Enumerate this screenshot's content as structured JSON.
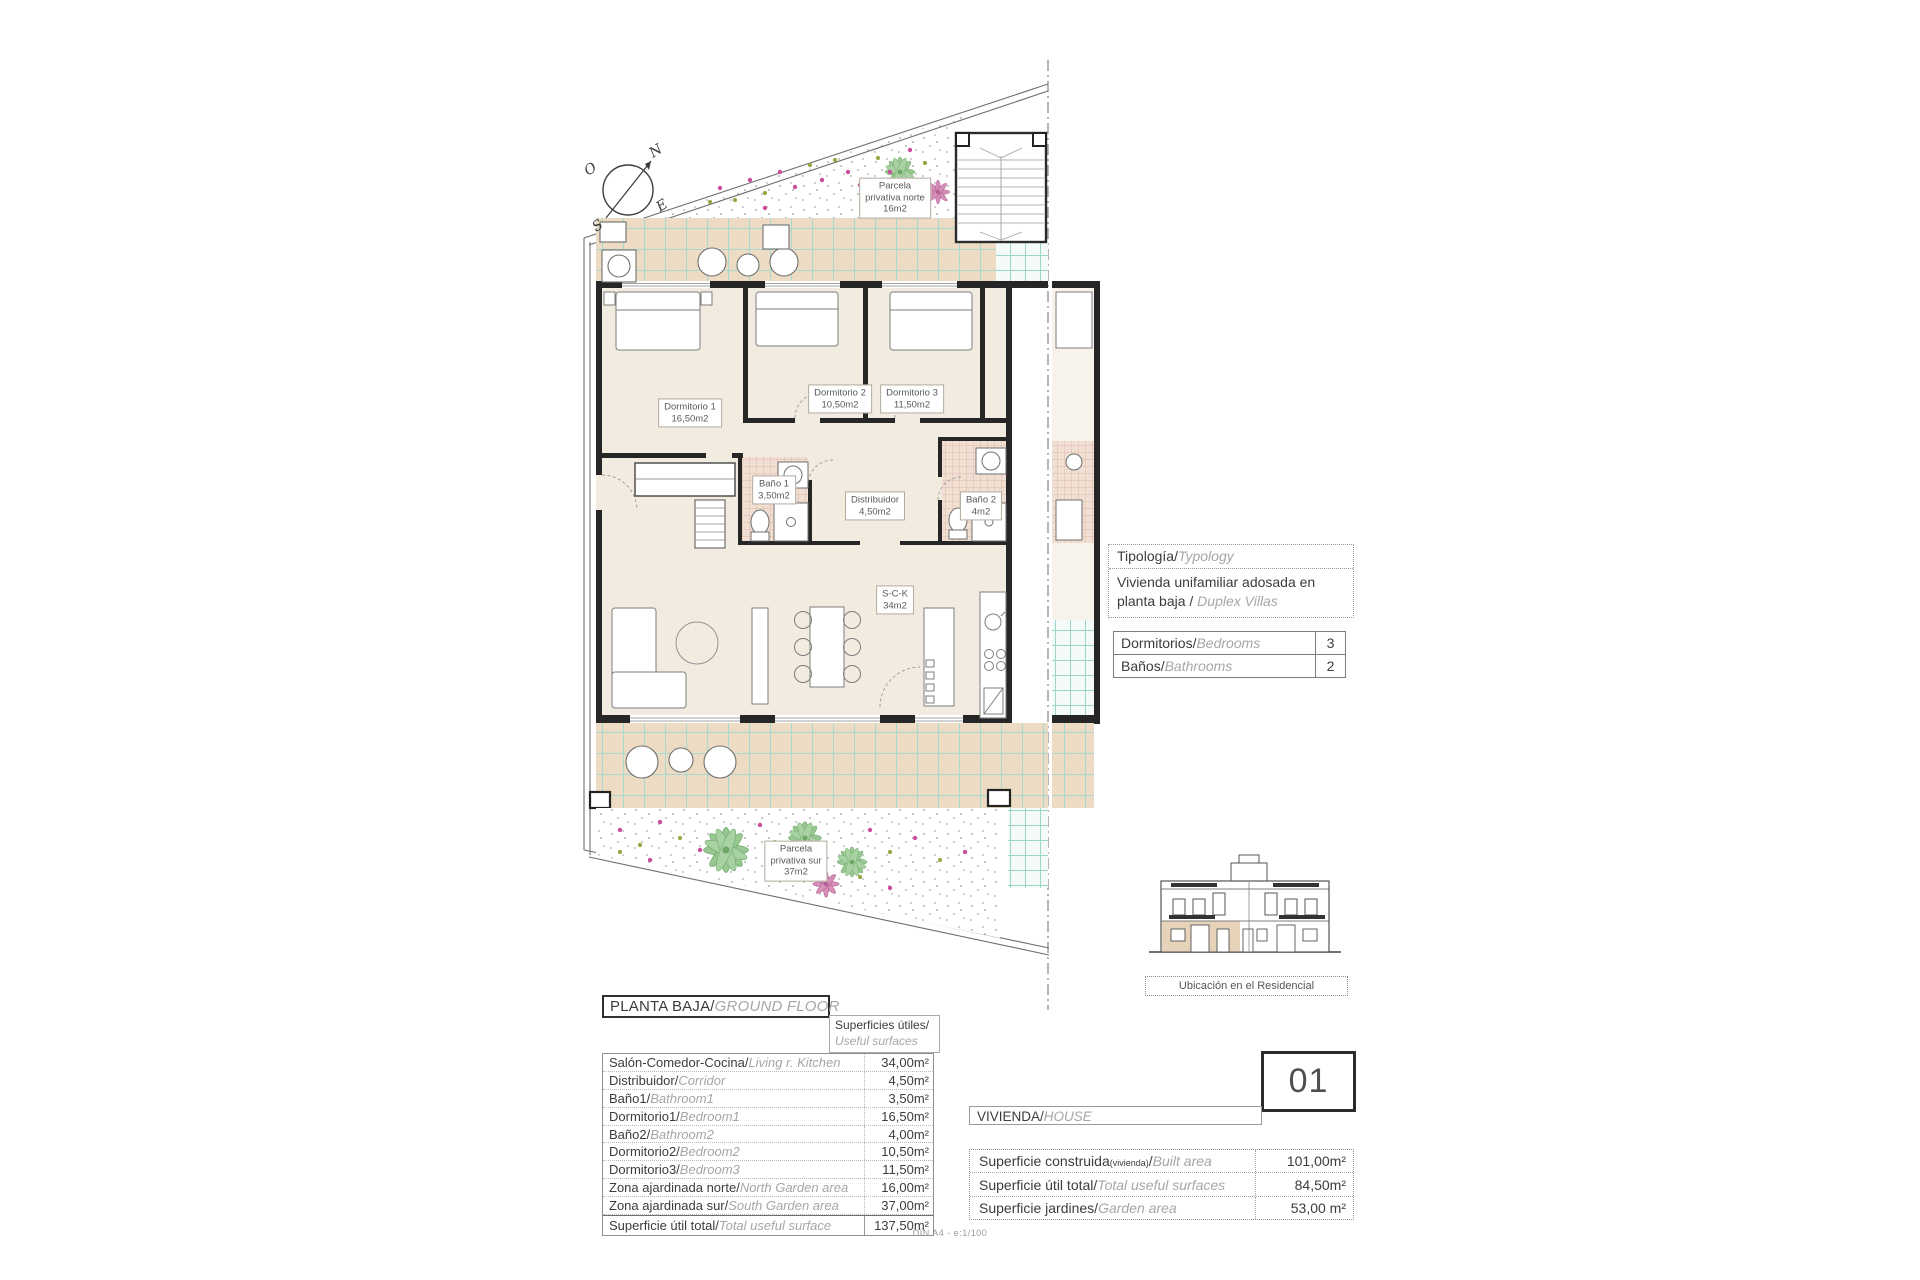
{
  "compass": {
    "n": "N",
    "s": "S",
    "e": "E",
    "o": "O"
  },
  "plan": {
    "parcela_norte": {
      "l1": "Parcela",
      "l2": "privativa norte",
      "l3": "16m2"
    },
    "parcela_sur": {
      "l1": "Parcela",
      "l2": "privativa sur",
      "l3": "37m2"
    },
    "rooms": {
      "d1": {
        "name": "Dormitorio 1",
        "area": "16,50m2"
      },
      "d2": {
        "name": "Dormitorio 2",
        "area": "10,50m2"
      },
      "d3": {
        "name": "Dormitorio 3",
        "area": "11,50m2"
      },
      "b1": {
        "name": "Baño 1",
        "area": "3,50m2"
      },
      "b2": {
        "name": "Baño 2",
        "area": "4m2"
      },
      "dist": {
        "name": "Distribuidor",
        "area": "4,50m2"
      },
      "sck": {
        "name": "S-C-K",
        "area": "34m2"
      }
    }
  },
  "typology": {
    "header_es": "Tipología/",
    "header_en": "Typology",
    "body_es": "Vivienda unifamiliar adosada en planta baja / ",
    "body_en": "Duplex Villas"
  },
  "counts": {
    "rows": [
      {
        "es": "Dormitorios/",
        "en": "Bedrooms",
        "value": "3"
      },
      {
        "es": "Baños/",
        "en": "Bathrooms",
        "value": "2"
      }
    ]
  },
  "location": {
    "caption": "Ubicación en el Residencial"
  },
  "ground_floor": {
    "title_es": "PLANTA BAJA/",
    "title_en": "GROUND FLOOR",
    "surfaces_hdr_es": "Superficies útiles/",
    "surfaces_hdr_en": "Useful surfaces",
    "rows": [
      {
        "es": "Salón-Comedor-Cocina/",
        "en": "Living r. Kitchen",
        "value": "34,00m²"
      },
      {
        "es": "Distribuidor/",
        "en": "Corridor",
        "value": "4,50m²"
      },
      {
        "es": "Baño1/",
        "en": "Bathroom1",
        "value": "3,50m²"
      },
      {
        "es": "Dormitorio1/",
        "en": "Bedroom1",
        "value": "16,50m²"
      },
      {
        "es": "Baño2/",
        "en": "Bathroom2",
        "value": "4,00m²"
      },
      {
        "es": "Dormitorio2/",
        "en": "Bedroom2",
        "value": "10,50m²"
      },
      {
        "es": "Dormitorio3/",
        "en": "Bedroom3",
        "value": "11,50m²"
      },
      {
        "es": "Zona ajardinada norte/",
        "en": "North Garden area",
        "value": "16,00m²"
      },
      {
        "es": "Zona ajardinada sur/",
        "en": "South Garden area",
        "value": "37,00m²"
      },
      {
        "es": "Superficie útil total/",
        "en": "Total useful surface",
        "value": "137,50m²"
      }
    ]
  },
  "unit": {
    "number": "01",
    "label_es": "VIVIENDA/",
    "label_en": "HOUSE",
    "rows": [
      {
        "es": "Superficie construida",
        "note": "(vivienda)",
        "sep": "/",
        "en": "Built area",
        "value": "101,00m²"
      },
      {
        "es": "Superficie útil total",
        "note": "",
        "sep": "/",
        "en": "Total useful surfaces",
        "value": "84,50m²"
      },
      {
        "es": "Superficie jardines",
        "note": "",
        "sep": "/",
        "en": "Garden area",
        "value": "53,00 m²"
      }
    ]
  },
  "page": {
    "footer": "DIN A4 - e:1/100"
  }
}
